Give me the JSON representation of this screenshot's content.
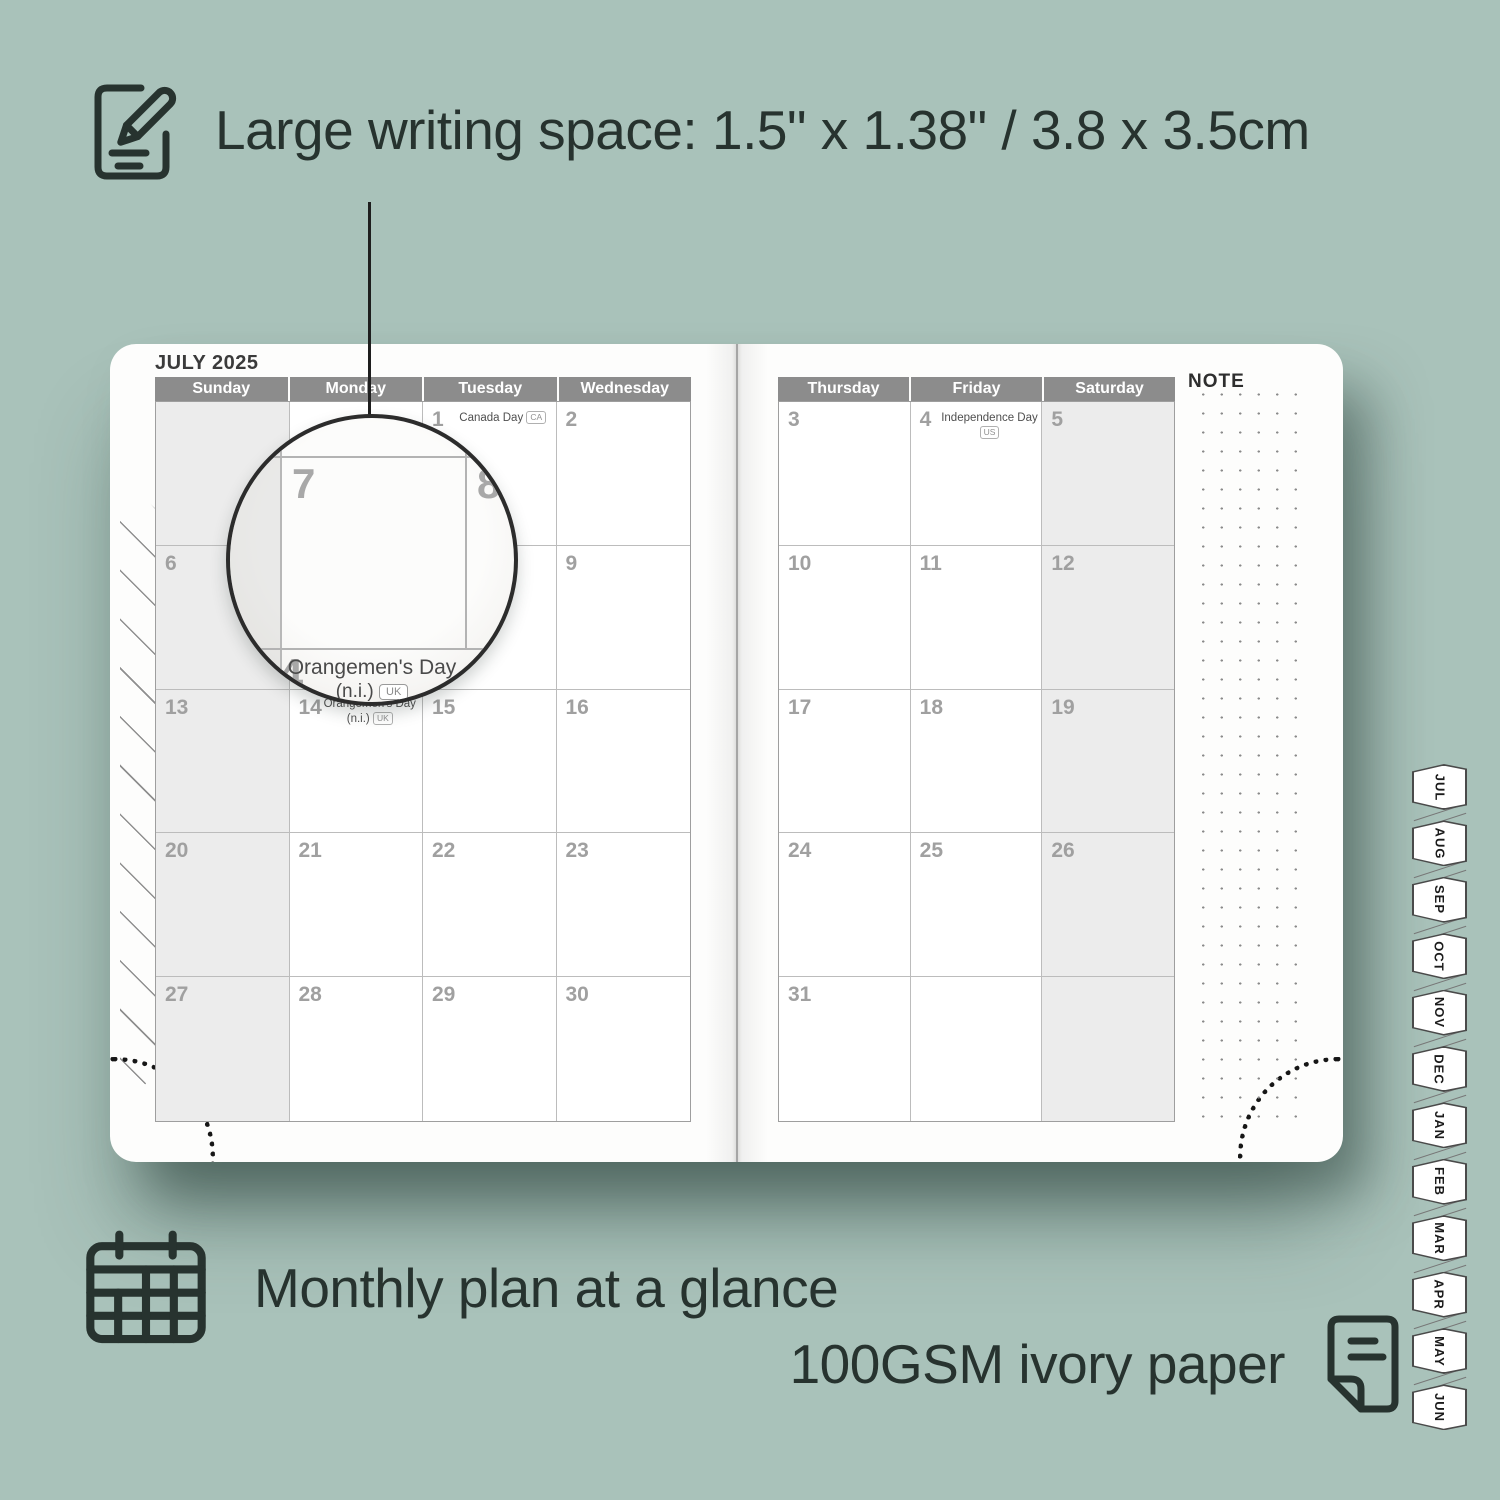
{
  "colors": {
    "background": "#a9c2ba",
    "ink": "#27332f",
    "header_gray": "#8c8c8c",
    "shaded_column": "#ececec",
    "page": "#fdfdfc"
  },
  "features": {
    "writing_space": {
      "icon": "notepad-pencil-icon",
      "text": "Large writing space: 1.5\" x 1.38\" / 3.8 x 3.5cm"
    },
    "monthly_plan": {
      "icon": "calendar-grid-icon",
      "text": "Monthly plan at a glance"
    },
    "paper": {
      "icon": "paper-sheet-icon",
      "text": "100GSM ivory paper"
    }
  },
  "planner": {
    "month_title": "JULY 2025",
    "note_label": "NOTE",
    "left_page": {
      "day_headers": [
        "Sunday",
        "Monday",
        "Tuesday",
        "Wednesday"
      ],
      "weeks": [
        [
          {
            "d": ""
          },
          {
            "d": ""
          },
          {
            "d": "1",
            "holiday": "Canada Day",
            "badge": "CA"
          },
          {
            "d": "2"
          }
        ],
        [
          {
            "d": "6"
          },
          {
            "d": "7"
          },
          {
            "d": "8"
          },
          {
            "d": "9"
          }
        ],
        [
          {
            "d": "13"
          },
          {
            "d": "14",
            "holiday": "Orangemen's Day",
            "holiday2": "(n.i.)",
            "badge": "UK",
            "two_line": true
          },
          {
            "d": "15"
          },
          {
            "d": "16"
          }
        ],
        [
          {
            "d": "20"
          },
          {
            "d": "21"
          },
          {
            "d": "22"
          },
          {
            "d": "23"
          }
        ],
        [
          {
            "d": "27"
          },
          {
            "d": "28"
          },
          {
            "d": "29"
          },
          {
            "d": "30"
          }
        ]
      ]
    },
    "right_page": {
      "day_headers": [
        "Thursday",
        "Friday",
        "Saturday"
      ],
      "weeks": [
        [
          {
            "d": "3"
          },
          {
            "d": "4",
            "holiday": "Independence Day",
            "badge": "US"
          },
          {
            "d": "5"
          }
        ],
        [
          {
            "d": "10"
          },
          {
            "d": "11"
          },
          {
            "d": "12"
          }
        ],
        [
          {
            "d": "17"
          },
          {
            "d": "18"
          },
          {
            "d": "19"
          }
        ],
        [
          {
            "d": "24"
          },
          {
            "d": "25"
          },
          {
            "d": "26"
          }
        ],
        [
          {
            "d": "31"
          },
          {
            "d": ""
          },
          {
            "d": ""
          }
        ]
      ]
    },
    "magnifier": {
      "day_a": "7",
      "day_b": "8",
      "day_c": "14",
      "holiday_line1": "Orangemen's Day",
      "holiday_line2": "(n.i.)",
      "badge": "UK"
    },
    "tabs": [
      "JUL",
      "AUG",
      "SEP",
      "OCT",
      "NOV",
      "DEC",
      "JAN",
      "FEB",
      "MAR",
      "APR",
      "MAY",
      "JUN"
    ]
  }
}
